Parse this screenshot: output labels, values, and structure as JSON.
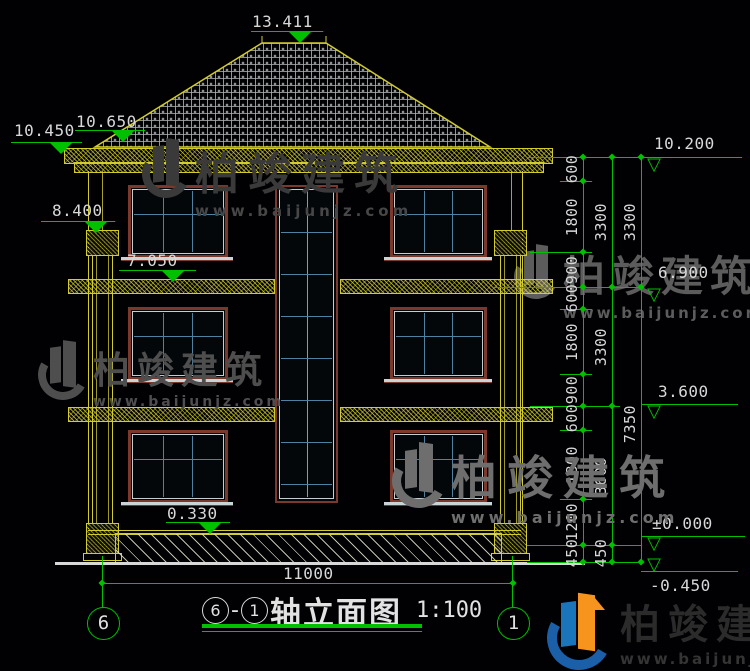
{
  "watermark": {
    "company": "柏竣建筑",
    "website": "www.baijunjz.com"
  },
  "brand": {
    "company": "柏竣建筑",
    "website": "www.baijunjz.com"
  },
  "title": {
    "axis_start": "6",
    "separator": "-",
    "axis_end": "1",
    "text": "轴立面图",
    "scale": "1:100"
  },
  "axes": {
    "left_bubble": "6",
    "right_bubble": "1"
  },
  "dims": {
    "total_width": "11000"
  },
  "elev_left": {
    "roof_top": "13.411",
    "eave_high": "10.650",
    "eave_low": "10.450",
    "capital": "8.400",
    "floor3_band": "7.050",
    "plinth": "0.330"
  },
  "elev_right": {
    "r1": "10.200",
    "r2": "6.900",
    "r3": "3.600",
    "r4": "±0.000",
    "r5": "-0.450"
  },
  "chain1": [
    "600",
    "1800",
    "900",
    "600",
    "1800",
    "900",
    "600",
    "1800",
    "1200",
    "450"
  ],
  "chain2": [
    "3300",
    "3300",
    "3600",
    "450"
  ],
  "chain3": [
    "3300",
    "7350"
  ]
}
